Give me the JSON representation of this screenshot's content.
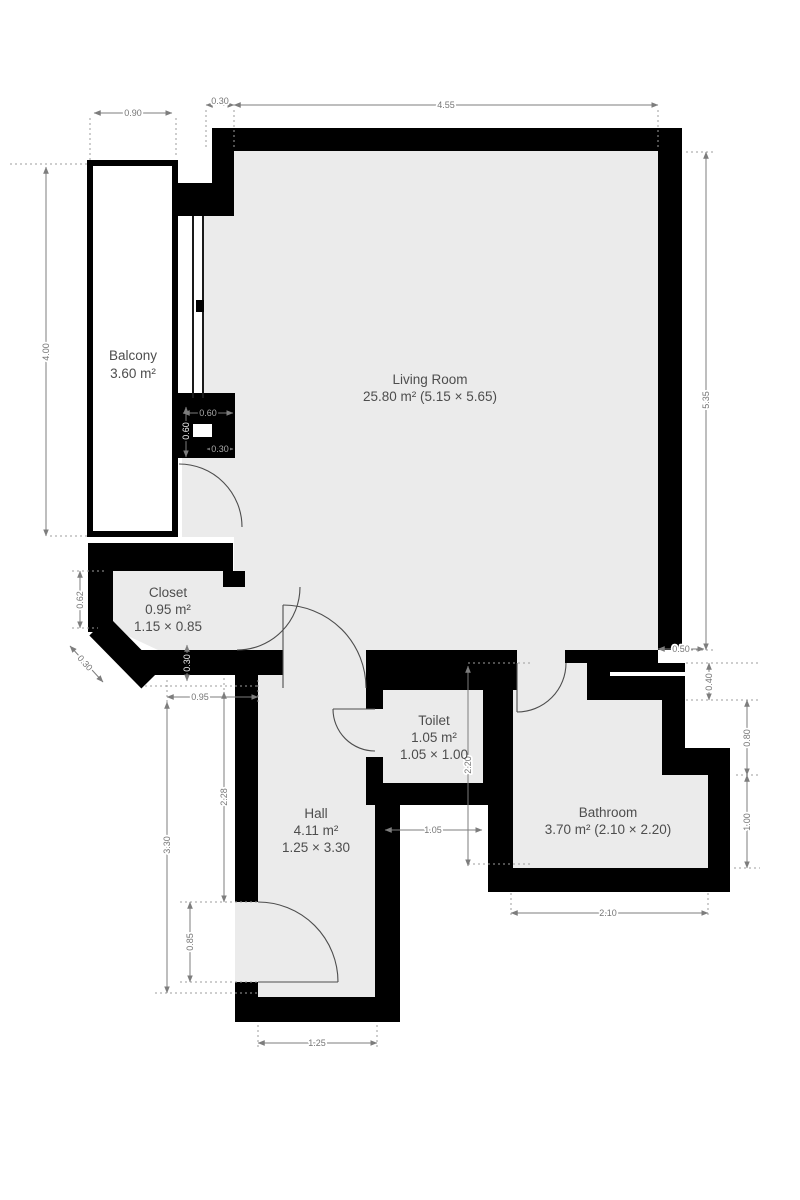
{
  "plan": {
    "rooms": {
      "balcony": {
        "name": "Balcony",
        "area": "3.60 m²"
      },
      "living_room": {
        "name": "Living Room",
        "area": "25.80 m² (5.15 × 5.65)"
      },
      "closet": {
        "name": "Closet",
        "area": "0.95 m²",
        "size": "1.15 × 0.85"
      },
      "toilet": {
        "name": "Toilet",
        "area": "1.05 m²",
        "size": "1.05 × 1.00"
      },
      "hall": {
        "name": "Hall",
        "area": "4.11 m²",
        "size": "1.25 × 3.30"
      },
      "bathroom": {
        "name": "Bathroom",
        "area": "3.70 m² (2.10 × 2.20)"
      }
    },
    "dimensions": {
      "balcony_width": "0.90",
      "top_wall_offset": "0.30",
      "living_top": "4.55",
      "balcony_height": "4.00",
      "living_right": "5.35",
      "closet_left_height": "0.62",
      "closet_chamfer": "0.30",
      "closet_wall": "0.30",
      "hall_top_width": "0.95",
      "hall_upper": "2.28",
      "hall_full": "3.30",
      "entry_door": "0.85",
      "hall_width": "1.25",
      "balcony_door_width": "0.60",
      "balcony_door_depth": "0.60",
      "balcony_door_offset": "0.30",
      "toilet_width": "1.05",
      "wet_zone_height": "2.20",
      "bath_top_offset": "0.50",
      "bath_step": "0.40",
      "bath_right_upper": "0.80",
      "bath_right_lower": "1.00",
      "bath_width": "2.10"
    },
    "colors": {
      "wall": "#000000",
      "floor": "#ebebeb",
      "dimension": "#7d7d7d",
      "label": "#4d4d4d"
    }
  }
}
